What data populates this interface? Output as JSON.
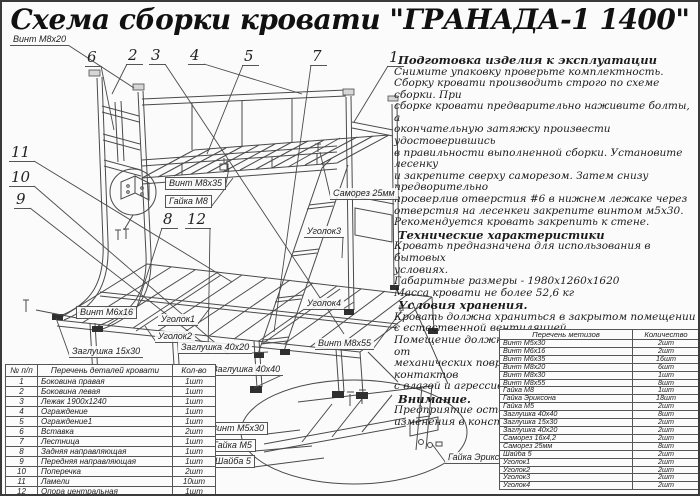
{
  "page": {
    "title": "Схема сборки кровати \"ГРАНАДА-1 1400\""
  },
  "colors": {
    "ink": "#1c1c1c",
    "line": "#4a4a4a",
    "background": "#fbfbfb"
  },
  "instructions": {
    "sections": [
      {
        "heading": "Подготовка изделия к эксплуатации",
        "lines": [
          "Снимите упаковку проверьте комплектность.",
          "Сборку кровати производить строго по схеме сборки. При",
          "сборке кровати  предварительно наживите  болты, а",
          "окончательную затяжку произвести удостоверившись",
          "в правильности выполненной сборки. Установите лесенку",
          "и закрепите сверху саморезом. Затем снизу предворительно",
          "просверлив отверстия #6 в нижнем лежаке через",
          "отверстия на лесенкеи закрепите винтом м5х30.",
          "Рекомендуется кровать закрепить к стене."
        ]
      },
      {
        "heading": "Технические характеристики",
        "lines": [
          "Кровать предназначена для использования в бытовых",
          "условиях.",
          "Габаритные размеры - 1980х1260х1620",
          "Масса кровати не более 52,6 кг"
        ]
      },
      {
        "heading": "Условия хранения.",
        "lines": [
          "Кровать должна храниться в закрытом помещении",
          "с естественной вентиляцией.",
          "Помещение должно обеспечивать защиту изделия от",
          "механических повреждений, загрязнения, контактов",
          "с влагой и агрессивной средой."
        ]
      },
      {
        "heading": "Внимание.",
        "lines": [
          "Предприятие оставляет за собой права вносить",
          "изменения в конструкцию кроватей."
        ]
      }
    ]
  },
  "parts_table": {
    "headers": [
      "№ п/п",
      "Перечень деталей кровати",
      "Кол-во"
    ],
    "rows": [
      [
        "1",
        "Боковина правая",
        "1шт"
      ],
      [
        "2",
        "Боковина левая",
        "1шт"
      ],
      [
        "3",
        "Лежак 1900х1240",
        "1шт"
      ],
      [
        "4",
        "Ограждение",
        "1шт"
      ],
      [
        "5",
        "Ограждение1",
        "1шт"
      ],
      [
        "6",
        "Вставка",
        "2шт"
      ],
      [
        "7",
        "Лестница",
        "1шт"
      ],
      [
        "8",
        "Задняя направляющая",
        "1шт"
      ],
      [
        "9",
        "Передняя направляющая",
        "1шт"
      ],
      [
        "10",
        "Поперечка",
        "2шт"
      ],
      [
        "11",
        "Ламели",
        "10шт"
      ],
      [
        "12",
        "Опора центральная",
        "1шт"
      ]
    ]
  },
  "hardware_table": {
    "headers": [
      "Перечень метизов",
      "Количество"
    ],
    "rows": [
      [
        "Винт М5х30",
        "2шт"
      ],
      [
        "Винт М6х16",
        "2шт"
      ],
      [
        "Винт М6х35",
        "16шт"
      ],
      [
        "Винт М8х20",
        "6шт"
      ],
      [
        "Винт М8х30",
        "1шт"
      ],
      [
        "Винт М8х55",
        "8шт"
      ],
      [
        "Гайка М8",
        "1шт"
      ],
      [
        "Гайка Эриксона",
        "18шт"
      ],
      [
        "Гайка М5",
        "2шт"
      ],
      [
        "Заглушка 40х40",
        "8шт"
      ],
      [
        "Заглушка 15х30",
        "2шт"
      ],
      [
        "Заглушка 40х20",
        "2шт"
      ],
      [
        "Саморез 16х4,2",
        "2шт"
      ],
      [
        "Саморез 25мм",
        "8шт"
      ],
      [
        "Шайба 5",
        "2шт"
      ],
      [
        "Уголок1",
        "2шт"
      ],
      [
        "Уголок2",
        "2шт"
      ],
      [
        "Уголок3",
        "2шт"
      ],
      [
        "Уголок4",
        "2шт"
      ]
    ]
  },
  "diagram": {
    "callouts": [
      {
        "n": "1",
        "x": 385,
        "y": 48,
        "tx": 352,
        "ty": 120
      },
      {
        "n": "2",
        "x": 124,
        "y": 46,
        "tx": 110,
        "ty": 92
      },
      {
        "n": "3",
        "x": 147,
        "y": 46,
        "tx": 342,
        "ty": 332
      },
      {
        "n": "4",
        "x": 186,
        "y": 46,
        "tx": 300,
        "ty": 92
      },
      {
        "n": "5",
        "x": 240,
        "y": 47,
        "tx": 205,
        "ty": 152
      },
      {
        "n": "6",
        "x": 83,
        "y": 48,
        "tx": 112,
        "ty": 128
      },
      {
        "n": "7",
        "x": 308,
        "y": 47,
        "tx": 272,
        "ty": 330
      },
      {
        "n": "8",
        "x": 159,
        "y": 210,
        "tx": 134,
        "ty": 308
      },
      {
        "n": "9",
        "x": 12,
        "y": 190,
        "tx": 200,
        "ty": 340
      },
      {
        "n": "10",
        "x": 7,
        "y": 168,
        "tx": 226,
        "ty": 352
      },
      {
        "n": "11",
        "x": 7,
        "y": 143,
        "tx": 230,
        "ty": 280
      },
      {
        "n": "12",
        "x": 183,
        "y": 210,
        "tx": 206,
        "ty": 352
      }
    ],
    "labels": [
      {
        "text": "Винт М8х20",
        "x": 8,
        "y": 32,
        "tx": 132,
        "ty": 86,
        "boxed": false
      },
      {
        "text": "Винт М8х35",
        "x": 163,
        "y": 175,
        "tx": 227,
        "ty": 166,
        "boxed": true
      },
      {
        "text": "Гайка М8",
        "x": 163,
        "y": 193,
        "tx": 231,
        "ty": 176,
        "boxed": true
      },
      {
        "text": "Саморез 25мм",
        "x": 328,
        "y": 186,
        "tx": 318,
        "ty": 150,
        "boxed": false
      },
      {
        "text": "Уголок3",
        "x": 302,
        "y": 224,
        "tx": 340,
        "ty": 256,
        "boxed": false
      },
      {
        "text": "Уголок4",
        "x": 302,
        "y": 296,
        "tx": 352,
        "ty": 300,
        "boxed": false
      },
      {
        "text": "Винт М8х55",
        "x": 313,
        "y": 336,
        "tx": 400,
        "ty": 308,
        "boxed": false
      },
      {
        "text": "Уголок1",
        "x": 156,
        "y": 312,
        "tx": 208,
        "ty": 306,
        "boxed": false
      },
      {
        "text": "Уголок2",
        "x": 153,
        "y": 329,
        "tx": 143,
        "ty": 324,
        "boxed": false
      },
      {
        "text": "Заглушка 40х20",
        "x": 176,
        "y": 340,
        "tx": 266,
        "ty": 350,
        "boxed": false
      },
      {
        "text": "Заглушка 40х40",
        "x": 207,
        "y": 362,
        "tx": 252,
        "ty": 386,
        "boxed": false
      },
      {
        "text": "Заглушка 15х30",
        "x": 67,
        "y": 344,
        "tx": 54,
        "ty": 316,
        "boxed": false
      },
      {
        "text": "Винт М6х16",
        "x": 74,
        "y": 304,
        "tx": 34,
        "ty": 308,
        "boxed": true
      },
      {
        "text": "Винт М5х30",
        "x": 205,
        "y": 420,
        "tx": 298,
        "ty": 428,
        "boxed": true
      },
      {
        "text": "Гайка М5",
        "x": 207,
        "y": 437,
        "tx": 310,
        "ty": 444,
        "boxed": true
      },
      {
        "text": "Шайба 5",
        "x": 209,
        "y": 453,
        "tx": 322,
        "ty": 456,
        "boxed": true
      },
      {
        "text": "Гайка Эриксона",
        "x": 443,
        "y": 450,
        "tx": 430,
        "ty": 442,
        "boxed": false
      }
    ]
  }
}
